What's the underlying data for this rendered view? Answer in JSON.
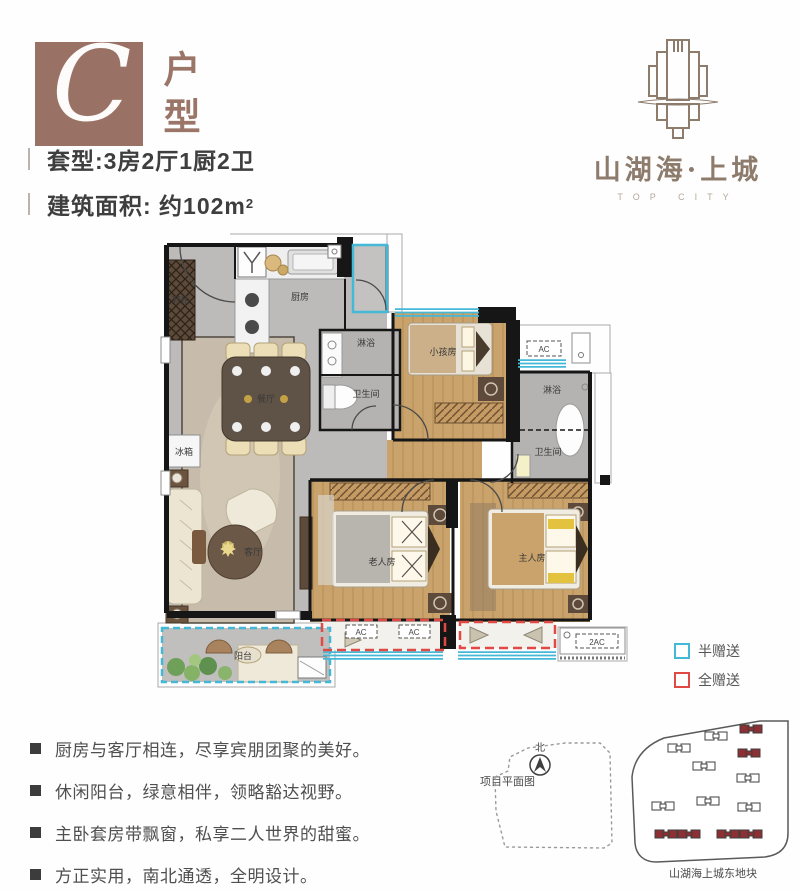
{
  "header": {
    "unit_letter": "C",
    "unit_type": "户型",
    "spec_line1": "套型:3房2厅1厨2卫",
    "spec_line2_prefix": "建筑面积: 约102m",
    "spec_line2_sup": "2"
  },
  "logo": {
    "name": "山湖海·上城",
    "tagline": "TOP CITY"
  },
  "floorplan": {
    "rooms": [
      "鞋柜",
      "厨房",
      "淋浴",
      "卫生间",
      "小孩房",
      "淋浴",
      "卫生间",
      "餐厅",
      "客厅",
      "冰箱",
      "老人房",
      "主人房",
      "阳台"
    ],
    "ac_labels": [
      "AC",
      "AC",
      "AC",
      "2AC"
    ],
    "colors": {
      "wall": "#161616",
      "window": "#45b8d8",
      "full_gift": "#e04a45",
      "wood": "#c9a36b",
      "floor": "#bcbbb9"
    }
  },
  "legend": {
    "items": [
      {
        "label": "半赠送",
        "color": "#45b8d8"
      },
      {
        "label": "全赠送",
        "color": "#e04a45"
      }
    ]
  },
  "features": [
    "厨房与客厅相连，尽享宾朋团聚的美好。",
    "休闲阳台，绿意相伴，领略豁达视野。",
    "主卧套房带飘窗，私享二人世界的甜蜜。",
    "方正实用，南北通透，全明设计。"
  ],
  "siteplan": {
    "north_label": "北",
    "title": "项目平面图",
    "plot_label": "山湖海上城东地块"
  }
}
